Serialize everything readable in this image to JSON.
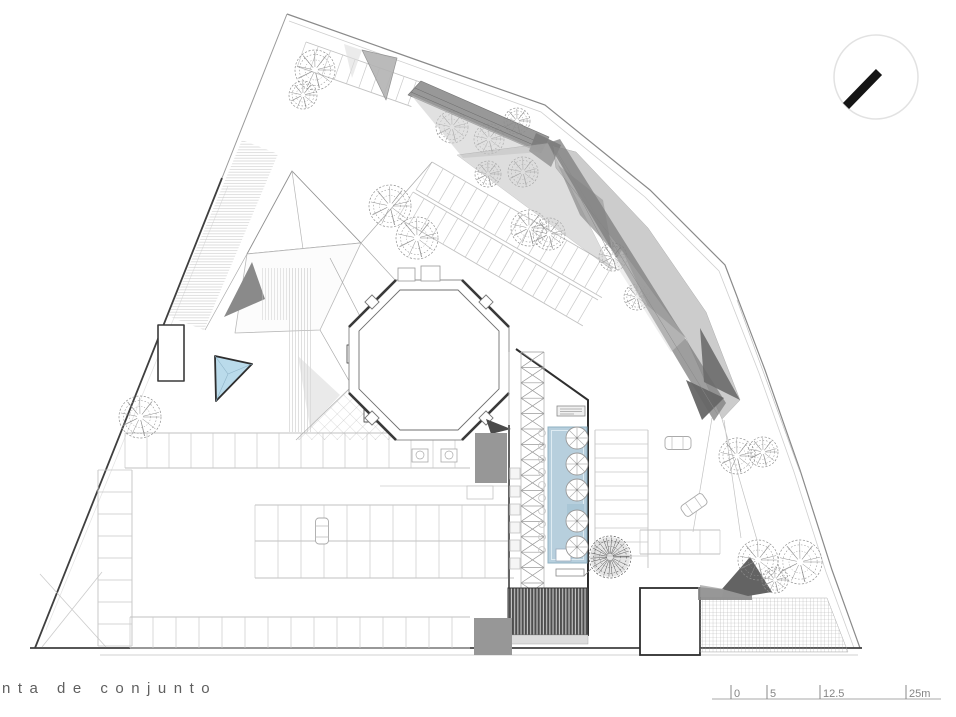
{
  "title": "nta de conjunto",
  "scale_bar": {
    "ticks": [
      {
        "label": "0"
      },
      {
        "label": "5"
      },
      {
        "label": "12.5"
      },
      {
        "label": "25m"
      }
    ]
  },
  "colors": {
    "pool": "#b7cfdd",
    "pool_edge": "#8fb0c2",
    "pool_platform": "#a9c6d6",
    "skylight": "#badbeb",
    "skylight_edge": "#2e2e2e",
    "canopy_dark": "#7e7e7e",
    "canopy_mid": "#ababab",
    "canopy_light": "#c9c9c9",
    "block_gray": "#979797",
    "tree": "#8f8f8f",
    "tree_dense": "#5a5a5a",
    "stall_line": "#c9c9c9",
    "boundary_dark": "#3f3f3f",
    "boundary_light": "#8a8a8a",
    "north_needle": "#151515"
  },
  "plan": {
    "trees": [
      {
        "x": 315,
        "y": 70,
        "r": 20
      },
      {
        "x": 303,
        "y": 95,
        "r": 14
      },
      {
        "x": 390,
        "y": 206,
        "r": 21
      },
      {
        "x": 417,
        "y": 238,
        "r": 21
      },
      {
        "x": 452,
        "y": 127,
        "r": 16
      },
      {
        "x": 489,
        "y": 139,
        "r": 15
      },
      {
        "x": 517,
        "y": 121,
        "r": 13
      },
      {
        "x": 488,
        "y": 174,
        "r": 13
      },
      {
        "x": 523,
        "y": 172,
        "r": 15
      },
      {
        "x": 529,
        "y": 228,
        "r": 18
      },
      {
        "x": 549,
        "y": 234,
        "r": 16
      },
      {
        "x": 613,
        "y": 257,
        "r": 14
      },
      {
        "x": 637,
        "y": 297,
        "r": 13
      },
      {
        "x": 140,
        "y": 417,
        "r": 21
      },
      {
        "x": 737,
        "y": 456,
        "r": 18
      },
      {
        "x": 763,
        "y": 452,
        "r": 15
      },
      {
        "x": 610,
        "y": 557,
        "r": 21,
        "dense": true
      },
      {
        "x": 758,
        "y": 560,
        "r": 20
      },
      {
        "x": 800,
        "y": 562,
        "r": 22
      },
      {
        "x": 775,
        "y": 580,
        "r": 13
      }
    ],
    "ladders": [
      {
        "x1": 125,
        "y1": 433,
        "x2": 470,
        "y2": 433,
        "w": 35,
        "s": 22
      },
      {
        "x1": 255,
        "y1": 505,
        "x2": 514,
        "y2": 505,
        "w": 36,
        "s": 23
      },
      {
        "x1": 255,
        "y1": 541,
        "x2": 514,
        "y2": 541,
        "w": 37,
        "s": 23
      },
      {
        "x1": 130,
        "y1": 617,
        "x2": 470,
        "y2": 617,
        "w": 31,
        "s": 23
      },
      {
        "x1": 132,
        "y1": 470,
        "x2": 132,
        "y2": 646,
        "w": 34,
        "s": 22
      },
      {
        "x1": 595,
        "y1": 430,
        "x2": 595,
        "y2": 568,
        "w": -53,
        "s": 14
      },
      {
        "x1": 640,
        "y1": 530,
        "x2": 720,
        "y2": 530,
        "w": 24,
        "s": 20
      },
      {
        "x1": 306,
        "y1": 42,
        "x2": 420,
        "y2": 82,
        "w": 26,
        "s": 13
      },
      {
        "x1": 432,
        "y1": 162,
        "x2": 618,
        "y2": 270,
        "w": 32,
        "s": 13
      },
      {
        "x1": 413,
        "y1": 192,
        "x2": 598,
        "y2": 300,
        "w": 30,
        "s": 13
      }
    ],
    "truss": {
      "x1": 521,
      "x2": 544,
      "y1": 352,
      "y2": 598,
      "step": 15.4
    },
    "umbrellas": [
      {
        "x": 577,
        "y": 438
      },
      {
        "x": 577,
        "y": 464
      },
      {
        "x": 577,
        "y": 490
      },
      {
        "x": 577,
        "y": 521
      },
      {
        "x": 577,
        "y": 547
      }
    ],
    "umbrella_r": 11,
    "chairs": {
      "x": 542,
      "y0": 433,
      "step": 13,
      "count": 10,
      "r": 3.4
    },
    "planters": {
      "x": 510,
      "y0": 468,
      "step": 18,
      "count": 6,
      "w": 10,
      "h": 11
    },
    "cars": [
      {
        "x": 322,
        "y": 531,
        "a": 0
      },
      {
        "x": 678,
        "y": 443,
        "a": 90
      },
      {
        "x": 694,
        "y": 505,
        "a": 55
      }
    ]
  }
}
